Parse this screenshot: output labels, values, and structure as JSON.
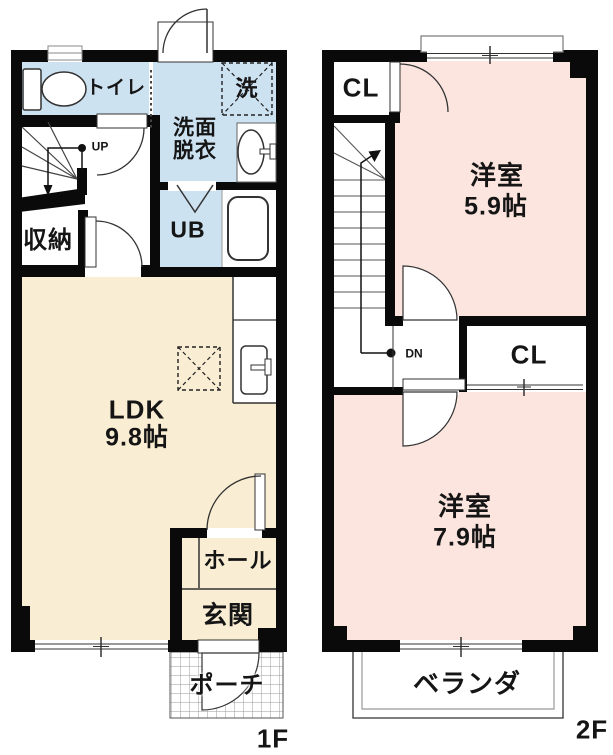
{
  "title": "2-story apartment floor plan",
  "colors": {
    "wall": "#0a0a0a",
    "wet": "#cde2f1",
    "ldk": "#f9edd3",
    "bed": "#fbe5de"
  },
  "f1": {
    "floor_label": "1F",
    "toilet": "トイレ",
    "washroom_line1": "洗面",
    "washroom_line2": "脱衣",
    "washer": "洗",
    "unit_bath": "UB",
    "storage": "収納",
    "ldk": "LDK",
    "ldk_size": "9.8帖",
    "hall": "ホール",
    "entrance": "玄関",
    "porch": "ポーチ",
    "stair_up": "UP"
  },
  "f2": {
    "floor_label": "2F",
    "closet_top": "CL",
    "room1": "洋室",
    "room1_size": "5.9帖",
    "closet_mid": "CL",
    "room2": "洋室",
    "room2_size": "7.9帖",
    "balcony": "ベランダ",
    "stair_down": "DN"
  },
  "icons": {
    "toilet-icon": "toilet tank and bowl",
    "washer-icon": "washing machine space (dashed X box)",
    "washbasin-icon": "washbasin oval with faucet",
    "bathtub-icon": "unit bath tub",
    "kitchen-sink-icon": "kitchen counter sink with faucet",
    "fridge-space-icon": "refrigerator space (dashed X box)",
    "door-arc-icon": "swing door quarter arc",
    "window-icon": "sliding window double line",
    "stairs-icon": "staircase treads with walk line",
    "porch-grid-icon": "tiled porch hatch",
    "balcony-rail-icon": "balcony railing double line"
  }
}
